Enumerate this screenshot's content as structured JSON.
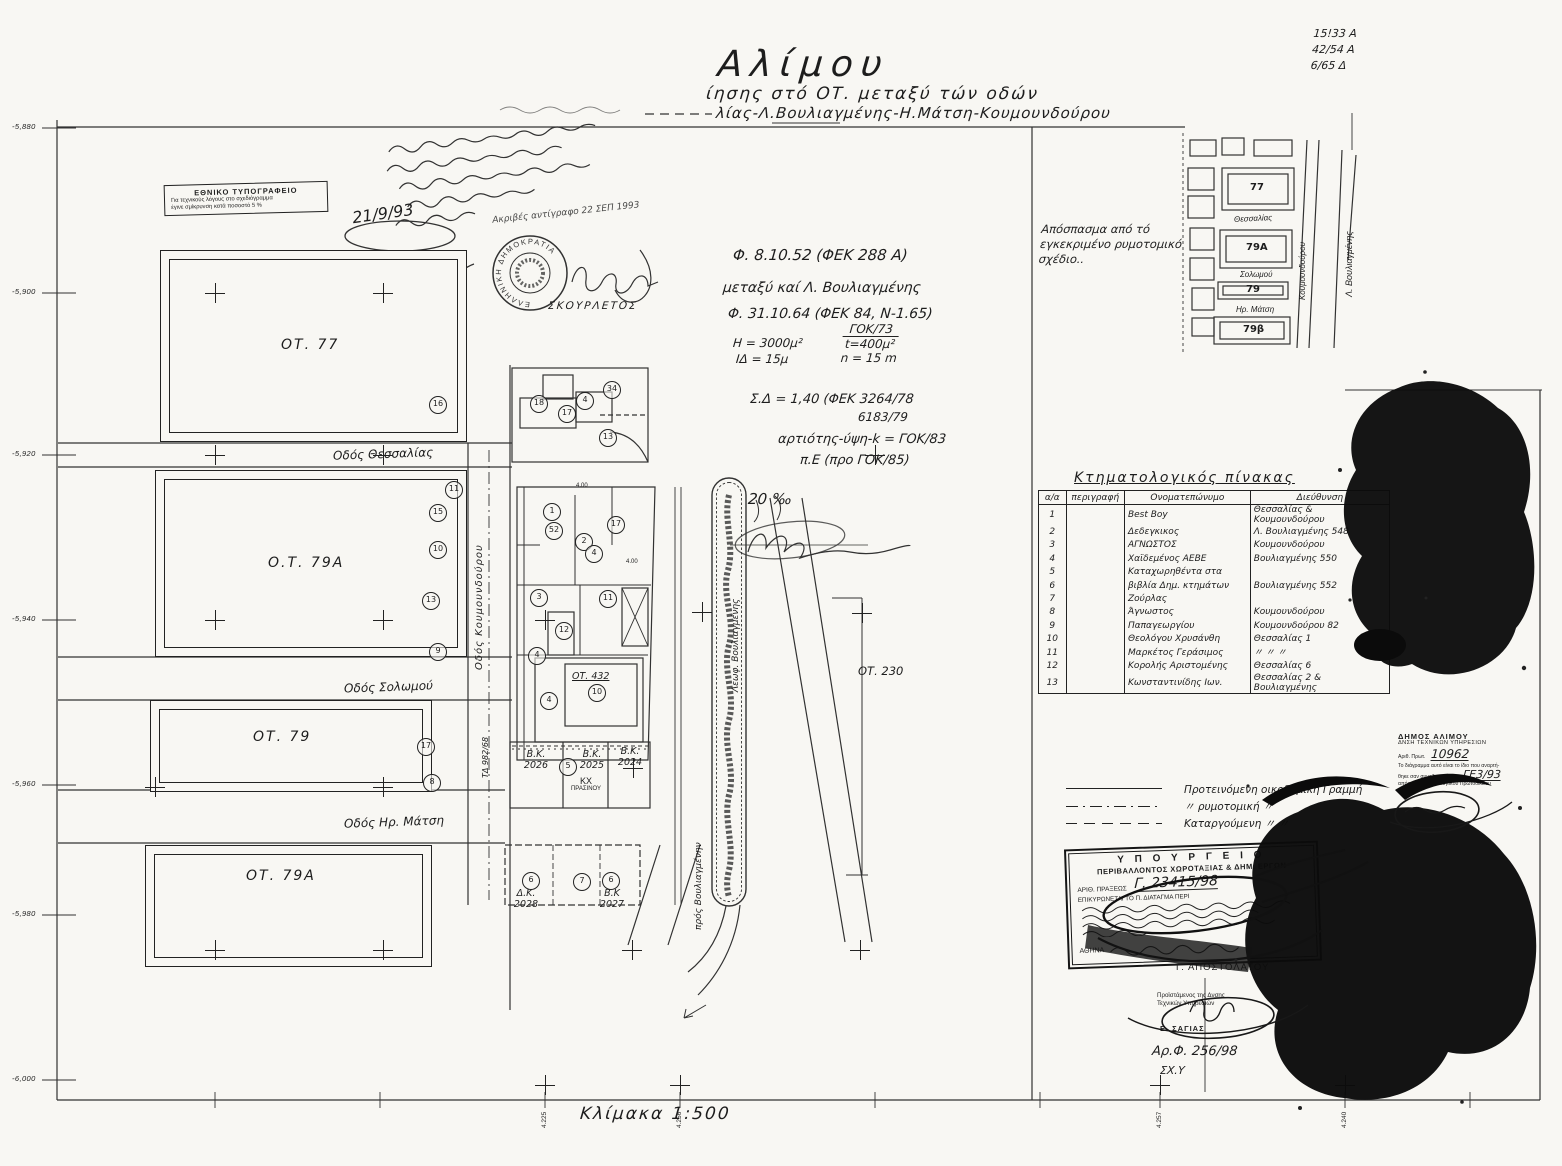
{
  "page": {
    "background": "#f8f7f3",
    "ink": "#1d1d1d"
  },
  "header": {
    "title": "Αλίμου",
    "subtitle1": "ίησης  στό  ΟΤ.  μεταξύ  τών  οδών",
    "subtitle2": "λίας-Λ.Βουλιαγμένης-Η.Μάτση-Κουμουνδούρου",
    "ref_numbers": [
      {
        "t": "15!33    Α"
      },
      {
        "t": "42/54    Α"
      },
      {
        "t": "6/65     Δ"
      }
    ]
  },
  "printing_stamp": {
    "line1": "ΕΘΝΙΚΟ ΤΥΠΟΓΡΑΦΕΙΟ",
    "line2": "Για τεχνικούς λόγους στο σχεδιόγραμμα",
    "line3": "έγινε σμίκρυνση κατά ποσοστό 5 %"
  },
  "handwritten": {
    "date": "21/9/93",
    "copy_note": "Ακριβές αντίγραφο 22 ΣΕΠ 1993",
    "seal_name": "ΣΚΟΥΡΛΕΤΟΣ",
    "seal_text": "ΕΛΛΗΝΙΚΗ ΔΗΜΟΚΡΑΤΙΑ",
    "flow_note": "20 ‰",
    "notes": [
      {
        "t": "Φ. 8.10.52 (ΦΕΚ 288 Α)",
        "x": 733,
        "y": 246,
        "s": 15
      },
      {
        "t": "μεταξύ καί Λ. Βουλιαγμένης",
        "x": 723,
        "y": 280,
        "s": 14
      },
      {
        "t": "Φ. 31.10.64 (ΦΕΚ 84, Ν-1.65)",
        "x": 728,
        "y": 306,
        "s": 14
      },
      {
        "t": "Η = 3000μ²",
        "x": 733,
        "y": 336,
        "s": 12
      },
      {
        "t": "ΙΔ = 15μ",
        "x": 736,
        "y": 352,
        "s": 12
      },
      {
        "t": "Σ.Δ = 1,40 (ΦΕΚ 3264/78",
        "x": 750,
        "y": 392,
        "s": 13
      },
      {
        "t": "6183/79",
        "x": 858,
        "y": 410,
        "s": 12
      },
      {
        "t": "αρτιότης-ύψη-k = ΓΟΚ/83",
        "x": 778,
        "y": 432,
        "s": 13
      },
      {
        "t": "π.Ε (προ ΓΟΚ/85)",
        "x": 800,
        "y": 453,
        "s": 13
      }
    ],
    "fraction": {
      "top": "ΓΟΚ/73",
      "mid": "t=400μ²",
      "bot": "n = 15 m"
    }
  },
  "plan": {
    "blocks": [
      {
        "label": "ΟΤ. 77"
      },
      {
        "label": "Ο.Τ. 79Α"
      },
      {
        "label": "ΟΤ. 79"
      },
      {
        "label": "ΟΤ. 79Α"
      }
    ],
    "streets": {
      "thessalias": "Οδός Θεσσαλίας",
      "koumoundourou": "Οδός Κουμουνδούρου",
      "solomou": "Οδός Σολωμού",
      "matsi": "Οδός Ηρ. Μάτση",
      "leoforos": "Λεωφ. Βουλιαγμένης",
      "pros": "πρός Βουλιαγμένην",
      "td": "ΤΔ 982/68"
    },
    "labels": {
      "ot432": "ΟΤ. 432",
      "ot230": "ΟΤ. 230",
      "kx1": "ΚΧ",
      "kx2": "ΠΡΑΣΙΝΟΥ",
      "dim1": "4.00",
      "dim2": "4.00"
    },
    "parcels": [
      {
        "t1": "Β.Κ.",
        "t2": "2026"
      },
      {
        "t1": "Β.Κ.",
        "t2": "2025"
      },
      {
        "t1": "Β.Κ.",
        "t2": "2024"
      },
      {
        "t1": "Δ.Κ.",
        "t2": "2028"
      },
      {
        "t1": "Β.Κ",
        "t2": "2027"
      }
    ],
    "margin_coords": [
      {
        "v": "-5,880",
        "y": 122
      },
      {
        "v": "-5,900",
        "y": 287
      },
      {
        "v": "-5,920",
        "y": 449
      },
      {
        "v": "-5,940",
        "y": 614
      },
      {
        "v": "-5,960",
        "y": 779
      },
      {
        "v": "-5,980",
        "y": 909
      },
      {
        "v": "-6,000",
        "y": 1074
      }
    ],
    "ruler_labels": [
      {
        "v": "4.225",
        "x": 541
      },
      {
        "v": "4.256",
        "x": 676
      },
      {
        "v": "4.257",
        "x": 1156
      },
      {
        "v": "4.240",
        "x": 1341
      }
    ],
    "scale": "Κλίμακα  1:500",
    "circles": [
      {
        "x": 437,
        "y": 404,
        "n": "16"
      },
      {
        "x": 538,
        "y": 403,
        "n": "18"
      },
      {
        "x": 566,
        "y": 413,
        "n": "17"
      },
      {
        "x": 584,
        "y": 400,
        "n": "4"
      },
      {
        "x": 611,
        "y": 389,
        "n": "34"
      },
      {
        "x": 607,
        "y": 437,
        "n": "13"
      },
      {
        "x": 453,
        "y": 489,
        "n": "11"
      },
      {
        "x": 437,
        "y": 512,
        "n": "15"
      },
      {
        "x": 437,
        "y": 549,
        "n": "10"
      },
      {
        "x": 430,
        "y": 600,
        "n": "13"
      },
      {
        "x": 437,
        "y": 651,
        "n": "9"
      },
      {
        "x": 551,
        "y": 511,
        "n": "1"
      },
      {
        "x": 553,
        "y": 530,
        "n": "52"
      },
      {
        "x": 615,
        "y": 524,
        "n": "17"
      },
      {
        "x": 583,
        "y": 541,
        "n": "2"
      },
      {
        "x": 593,
        "y": 553,
        "n": "4"
      },
      {
        "x": 538,
        "y": 597,
        "n": "3"
      },
      {
        "x": 607,
        "y": 598,
        "n": "11"
      },
      {
        "x": 563,
        "y": 630,
        "n": "12"
      },
      {
        "x": 536,
        "y": 655,
        "n": "4"
      },
      {
        "x": 548,
        "y": 700,
        "n": "4"
      },
      {
        "x": 596,
        "y": 692,
        "n": "10"
      },
      {
        "x": 567,
        "y": 766,
        "n": "5"
      },
      {
        "x": 425,
        "y": 746,
        "n": "17"
      },
      {
        "x": 431,
        "y": 782,
        "n": "8"
      },
      {
        "x": 530,
        "y": 880,
        "n": "6"
      },
      {
        "x": 581,
        "y": 881,
        "n": "7"
      },
      {
        "x": 610,
        "y": 880,
        "n": "6"
      }
    ],
    "crosses": [
      {
        "x": 215,
        "y": 293
      },
      {
        "x": 383,
        "y": 293
      },
      {
        "x": 215,
        "y": 455
      },
      {
        "x": 383,
        "y": 455
      },
      {
        "x": 215,
        "y": 620
      },
      {
        "x": 383,
        "y": 620
      },
      {
        "x": 545,
        "y": 620
      },
      {
        "x": 155,
        "y": 787
      },
      {
        "x": 383,
        "y": 787
      },
      {
        "x": 215,
        "y": 950
      },
      {
        "x": 383,
        "y": 950
      },
      {
        "x": 632,
        "y": 950
      },
      {
        "x": 860,
        "y": 950
      },
      {
        "x": 702,
        "y": 612
      },
      {
        "x": 862,
        "y": 613
      },
      {
        "x": 875,
        "y": 455
      },
      {
        "x": 633,
        "y": 768
      },
      {
        "x": 545,
        "y": 1085
      },
      {
        "x": 680,
        "y": 1085
      },
      {
        "x": 1160,
        "y": 1085
      },
      {
        "x": 1345,
        "y": 1085
      }
    ]
  },
  "inset": {
    "caption1": "Απόσπασμα  από  τό",
    "caption2": "εγκεκριμένο  ρυμοτομικό",
    "caption3": "σχέδιο..",
    "blocks": [
      {
        "label": "77"
      },
      {
        "label": "79Α"
      },
      {
        "label": "79"
      },
      {
        "label": "79β"
      }
    ],
    "streets": {
      "thessalias": "Θεσσαλίας",
      "solomou": "Σολωμού",
      "matsi": "Ηρ. Μάτση",
      "koumoundourou": "Κουμουνδούρου",
      "vouliagmenis": "Λ. Βουλιαγμένης"
    }
  },
  "table": {
    "title": "Κτηματολογικός  πίνακας",
    "headers": {
      "c1": "α/α",
      "c2": "περιγραφή",
      "c3": "Ονοματεπώνυμο",
      "c4": "Διεύθυνση"
    },
    "rows": [
      {
        "n": "1",
        "name": "Best Boy",
        "addr": "Θεσσαλίας & Κουμουνδούρου"
      },
      {
        "n": "2",
        "name": "Δεδεγκικος",
        "addr": "Λ. Βουλιαγμένης 548"
      },
      {
        "n": "3",
        "name": "ΑΓΝΩΣΤΟΣ",
        "addr": "Κουμουνδούρου"
      },
      {
        "n": "4",
        "name": "Χαϊδεμένος ΑΕΒΕ",
        "addr": "Βουλιαγμένης 550"
      },
      {
        "n": "5",
        "name": "Καταχωρηθέντα στα",
        "addr": ""
      },
      {
        "n": "6",
        "name": "βιβλία Δημ. κτημάτων",
        "addr": "Βουλιαγμένης 552"
      },
      {
        "n": "7",
        "name": "Ζούρλας",
        "addr": ""
      },
      {
        "n": "8",
        "name": "Άγνωστος",
        "addr": "Κουμουνδούρου"
      },
      {
        "n": "9",
        "name": "Παπαγεωργίου",
        "addr": "Κουμουνδούρου 82"
      },
      {
        "n": "10",
        "name": "Θεολόγου Χρυσάνθη",
        "addr": "Θεσσαλίας 1"
      },
      {
        "n": "11",
        "name": "Μαρκέτος Γεράσιμος",
        "addr": "〃   〃   〃"
      },
      {
        "n": "12",
        "name": "Κορολής Αριστομένης",
        "addr": "Θεσσαλίας 6"
      },
      {
        "n": "13",
        "name": "Κωνσταντινίδης Ιων.",
        "addr": "Θεσσαλίας 2 & Βουλιαγμένης"
      }
    ]
  },
  "legend": {
    "items": [
      {
        "label": "Προτεινόμενη  οικοδομική  Γραμμή"
      },
      {
        "label": "〃          ρυμοτομική          〃"
      },
      {
        "label": "Καταργούμενη          〃              〃"
      }
    ]
  },
  "ministry_stamp": {
    "line1": "Υ Π Ο Υ Ρ Γ Ε Ι Ο",
    "line2": "ΠΕΡΙΒΑΛΛΟΝΤΟΣ ΧΩΡΟΤΑΞΙΑΣ & ΔΗΜ. ΕΡΓΩΝ",
    "praxis_label": "ΑΡΙΘ. ΠΡΑΞΕΩΣ",
    "praxis_value": "Γ. 23415/98",
    "line3": "ΕΠΙΚΥΡΩΝΕΤΑΙ ΤΟ Π. ΔΙΑΤΑΓΜΑ ΠΕΡΙ",
    "city_label": "ΑΘΗΝΑ"
  },
  "municipality_stamp": {
    "line1": "ΔΗΜΟΣ ΑΛΙΜΟΥ",
    "line2": "ΔΝΣΗ ΤΕΧΝΙΚΩΝ ΥΠΗΡΕΣΙΩΝ",
    "proto_label": "Αριθ. Πρωτ.",
    "proto_value": "10962",
    "line3": "Το διάγραμμα αυτό είναι το ίδιο που αναρτή-",
    "line4": "θηκε σαν συνοδευτικό της",
    "ref_value": "ΓΕ3/93",
    "line5": "απόφασης του Διοικητικού Πρωτοδικείου",
    "line6": "Αθήνα"
  },
  "signatures": {
    "name1": "Γ. ΑΠΟΣΤΟΛΑΤΟΥ",
    "role1": "Προϊστάμενος της Δνσης",
    "role2": "Τεχνικών Υπηρεσιών",
    "name2": "Ε. ΣΑΓΙΑΣ",
    "file_ref": "Αρ.Φ. 256/98",
    "file_ref2": "ΣΧ.Υ"
  }
}
